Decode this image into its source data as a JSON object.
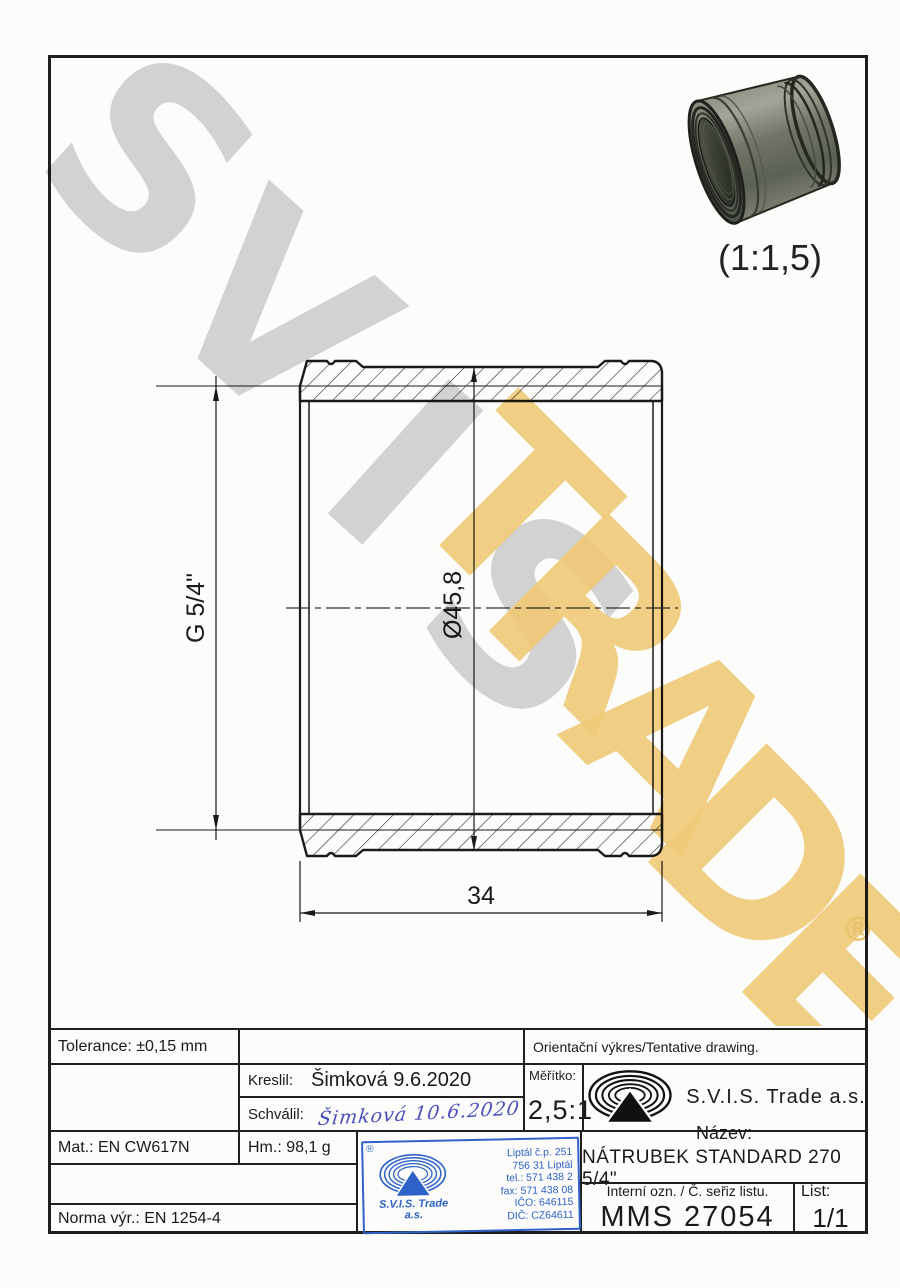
{
  "watermark": {
    "line1": "SVIS",
    "line2": "TRADE",
    "registered": "®"
  },
  "render": {
    "caption": "(1:1,5)"
  },
  "drawing": {
    "dim_thread": "G 5/4\"",
    "dim_diameter": "Ø45,8",
    "dim_length": "34"
  },
  "title_block": {
    "tolerance": "Tolerance: ±0,15 mm",
    "orientacni": "Orientační výkres/Tentative drawing.",
    "kreslil_label": "Kreslil:",
    "kreslil_value": "Šimková 9.6.2020",
    "schvalil_label": "Schválil:",
    "schvalil_signature": "Šimková 10.6.2020",
    "meritko_label": "Měřítko:",
    "meritko_value": "2,5:1",
    "company": "S.V.I.S. Trade a.s.",
    "mat": "Mat.: EN CW617N",
    "hm": "Hm.: 98,1 g",
    "norma": "Norma výr.: EN 1254-4",
    "nazev_label": "Název:",
    "nazev_value": "NÁTRUBEK STANDARD 270 5/4\"",
    "interni_label": "Interní ozn. / Č. seřiz listu.",
    "interni_value": "MMS 27054",
    "list_label": "List:",
    "list_value": "1/1"
  },
  "stamp": {
    "registered": "®",
    "company_line1": "S.V.I.S. Trade",
    "company_line2": "a.s.",
    "address_lines": [
      "Liptál č.p. 251",
      "756 31 Liptál",
      "tel.: 571 438 2",
      "fax: 571 438 08",
      "IČO: 646115",
      "DIČ: CZ64611"
    ]
  }
}
